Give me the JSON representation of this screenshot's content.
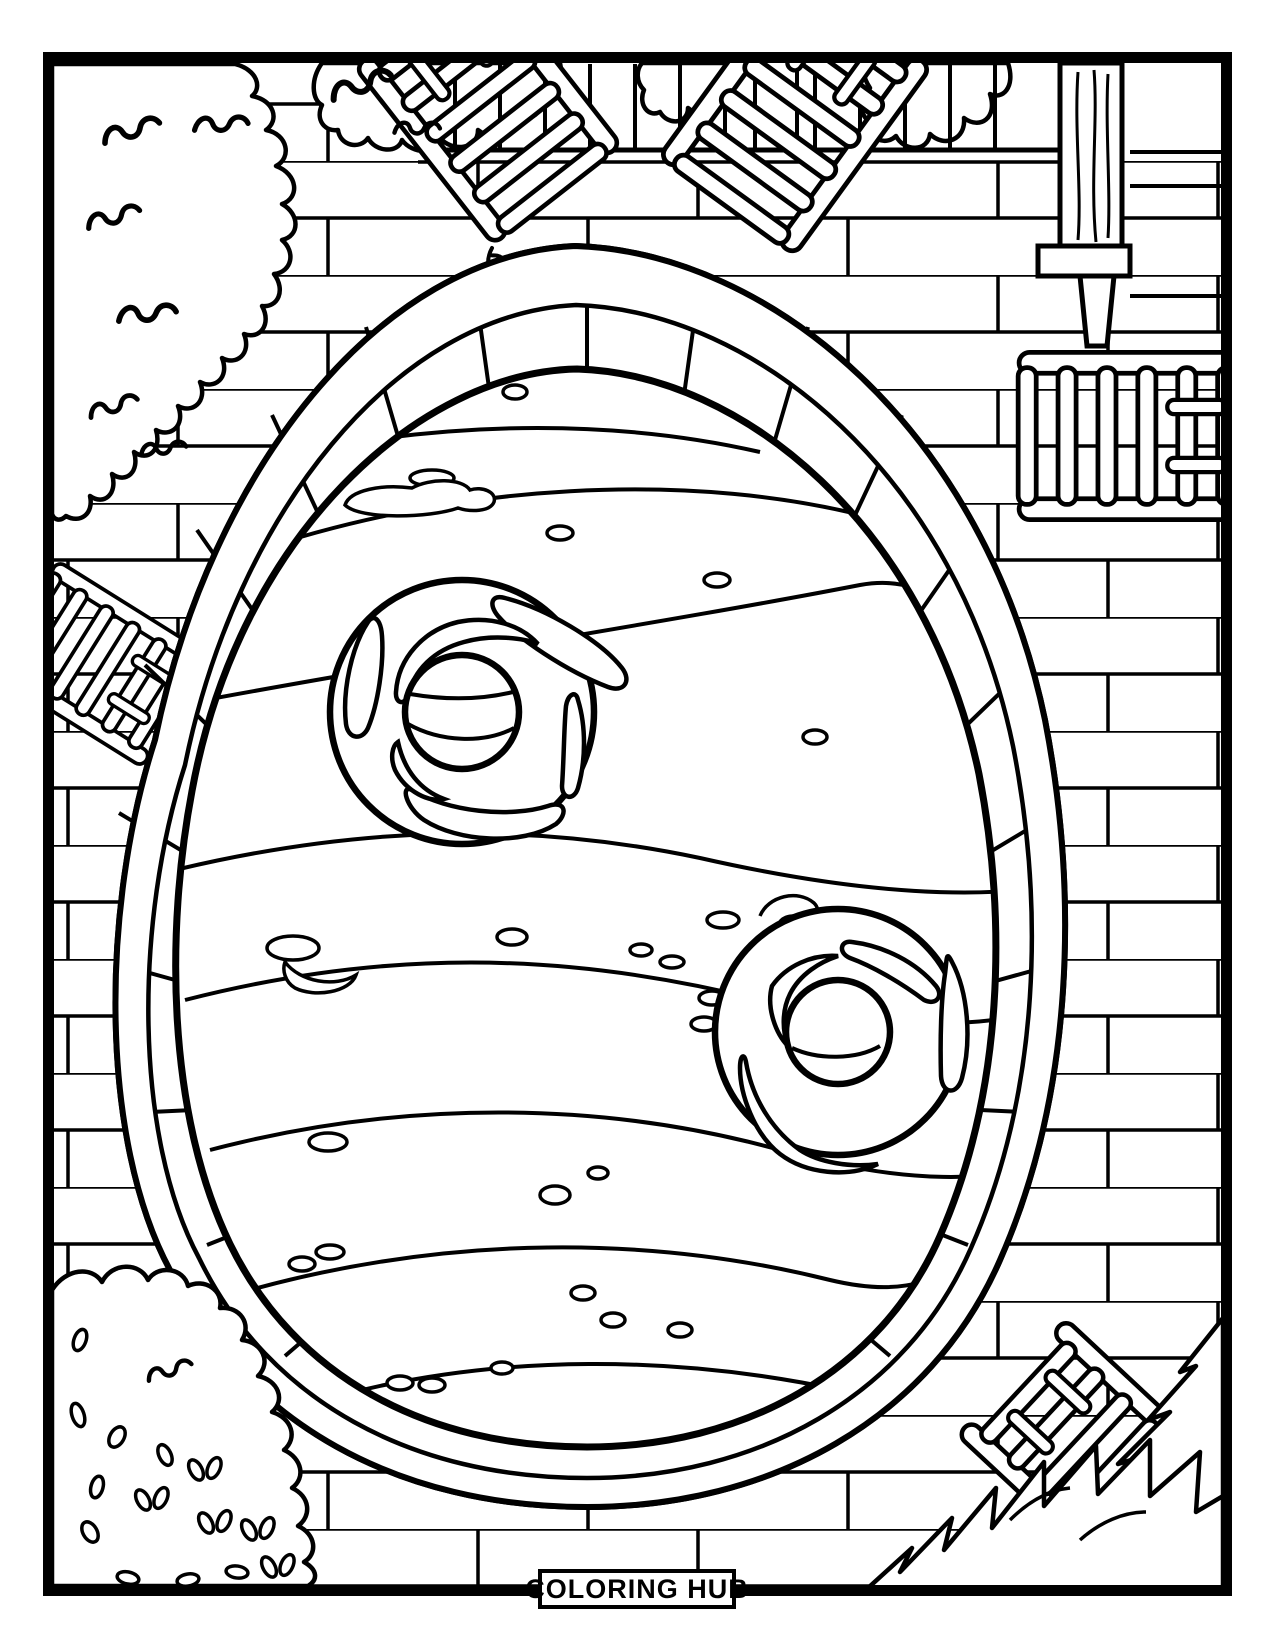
{
  "page": {
    "paper_color": "#ffffff",
    "ink_color": "#000000"
  },
  "footer": {
    "brand_label": "COLORING HUB"
  }
}
